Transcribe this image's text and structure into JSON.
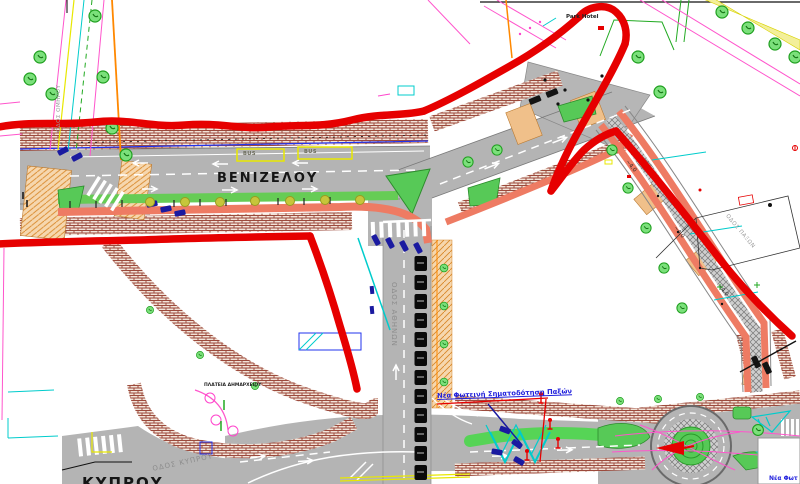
{
  "drawing": {
    "type": "street-redesign-cad-plan",
    "annotation": {
      "tool": "freehand-marker",
      "color": "#e60000"
    }
  },
  "labels": {
    "main_street": "ΒΕΝΙΖΕΛΟΥ",
    "south_street": "ΟΔΟΣ ΑΘΗΝΩΝ",
    "southwest_street": "ΟΔΟΣ ΚΥΠΡΟΥ",
    "southwest_street_big": "ΚΥΠΡΟΥ",
    "left_street": "ΟΔΟΣ ΟΜΗΡΟΥ",
    "right_street": "ΟΔΟΣ ΠΑΞΩΝ",
    "square": "ΠΛΑΤΕΙΑ ΔΗΜΑΡΧΕΙΟΥ",
    "hotel": "Park Hotel",
    "signal_note": "Νέα Φωτεινή Σηματοδότηση Παξών",
    "signal_note_partial": "Νέα Φωτ",
    "bus_bay": "BUS",
    "dim_width": "~4.0"
  },
  "colors": {
    "annotation_red": "#e60000",
    "road_gray": "#b4b4b4",
    "sidewalk_brick": "#a14b3c",
    "bike_lane_salmon": "#ee7b63",
    "green_island": "#57c957",
    "verge_green": "#66cc55",
    "note_blue": "#2222dd",
    "bus_yellow": "#e8e800",
    "crossing_tan": "#f0c08a",
    "car_navy": "#1a1aa0"
  }
}
